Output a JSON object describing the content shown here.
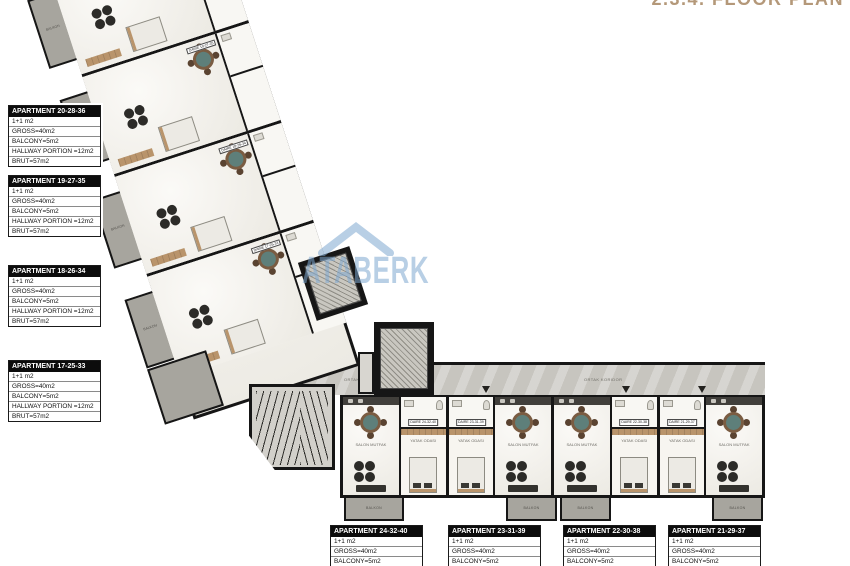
{
  "title": "2.3.4. FLOOR PLAN",
  "watermark": {
    "text": "ATABERK"
  },
  "left_apartments": [
    {
      "name": "APARTMENT 20-28-36",
      "lines": [
        "1+1 m2",
        "GROSS=40m2",
        "BALCONY=5m2",
        "HALLWAY PORTION =12m2",
        "BRUT=57m2"
      ]
    },
    {
      "name": "APARTMENT 19-27-35",
      "lines": [
        "1+1 m2",
        "GROSS=40m2",
        "BALCONY=5m2",
        "HALLWAY PORTION =12m2",
        "BRUT=57m2"
      ]
    },
    {
      "name": "APARTMENT 18-26-34",
      "lines": [
        "1+1 m2",
        "GROSS=40m2",
        "BALCONY=5m2",
        "HALLWAY PORTION =12m2",
        "BRUT=57m2"
      ]
    },
    {
      "name": "APARTMENT 17-25-33",
      "lines": [
        "1+1 m2",
        "GROSS=40m2",
        "BALCONY=5m2",
        "HALLWAY PORTION =12m2",
        "BRUT=57m2"
      ]
    }
  ],
  "bottom_apartments": [
    {
      "name": "APARTMENT 24-32-40",
      "lines": [
        "1+1 m2",
        "GROSS=40m2",
        "BALCONY=5m2",
        "HALLWAY PORTION =12m2",
        "BRUT=57m2"
      ]
    },
    {
      "name": "APARTMENT 23-31-39",
      "lines": [
        "1+1 m2",
        "GROSS=40m2",
        "BALCONY=5m2",
        "HALLWAY PORTION =12m2",
        "BRUT=57m2"
      ]
    },
    {
      "name": "APARTMENT 22-30-38",
      "lines": [
        "1+1 m2",
        "GROSS=40m2",
        "BALCONY=5m2",
        "HALLWAY PORTION =12m2",
        "BRUT=57m2"
      ]
    },
    {
      "name": "APARTMENT 21-29-37",
      "lines": [
        "1+1 m2",
        "GROSS=40m2",
        "BALCONY=5m2",
        "HALLWAY PORTION =12m2",
        "BRUT=57m2"
      ]
    }
  ],
  "plan": {
    "corridor_label": "ORTAK KORIDOR",
    "room_labels": {
      "living": "SALON MUTFAK",
      "bedroom": "YATAK ODASI",
      "balcony": "BALKON"
    },
    "bottom_units": [
      {
        "daire": "DAIRE 24-32-40"
      },
      {
        "daire": "DAIRE 23-31-39"
      },
      {
        "daire": "DAIRE 22-30-38"
      },
      {
        "daire": "DAIRE 21-29-37"
      }
    ],
    "diag_units": [
      {
        "daire": "DAIRE 20-28-36"
      },
      {
        "daire": "DAIRE 19-27-35"
      },
      {
        "daire": "DAIRE 18-26-34"
      },
      {
        "daire": "DAIRE 17-25-33"
      }
    ],
    "colors": {
      "title": "#b49879",
      "wall": "#161616",
      "balcony": "#a7a59e",
      "corridor": "#c7c5bf",
      "watermark": "#7da8d0"
    }
  }
}
